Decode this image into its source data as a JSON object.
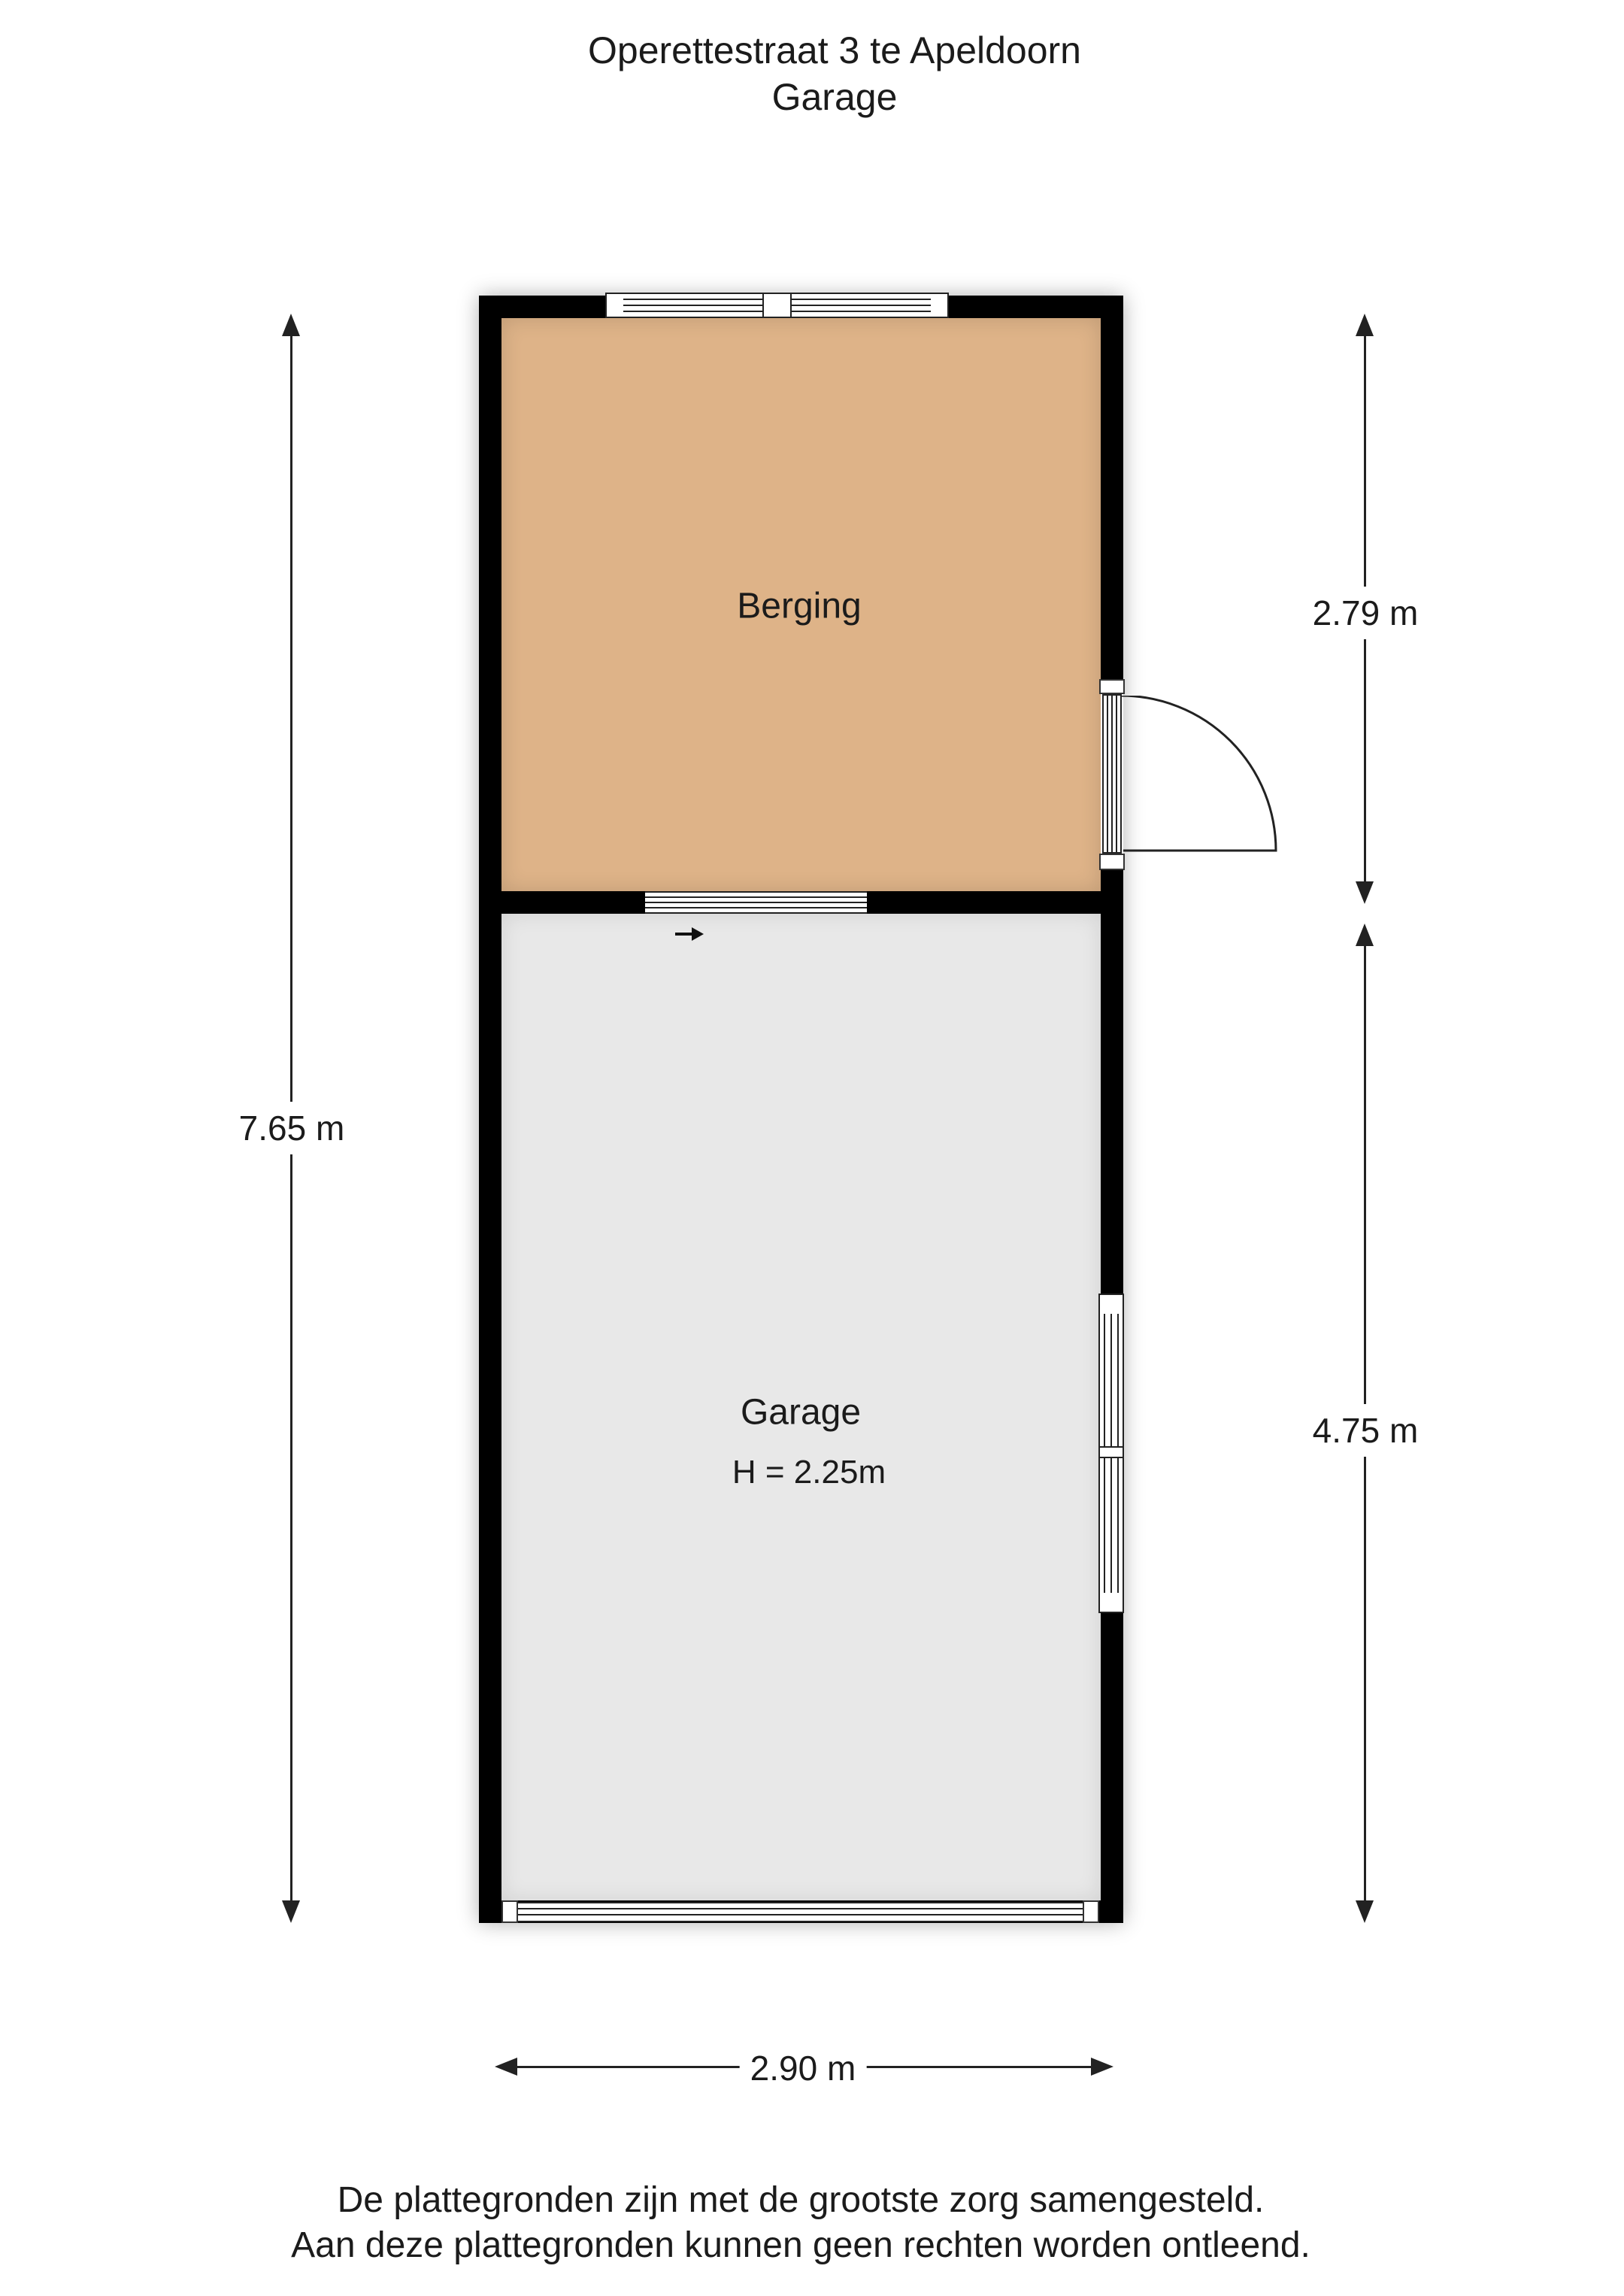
{
  "title": {
    "line1": "Operettestraat 3 te Apeldoorn",
    "line2": "Garage"
  },
  "rooms": {
    "berging": {
      "label": "Berging"
    },
    "garage": {
      "label": "Garage",
      "height_note": "H = 2.25m"
    }
  },
  "dimensions": {
    "overall_height": "7.65 m",
    "berging_height": "2.79 m",
    "garage_height": "4.75 m",
    "overall_width": "2.90 m"
  },
  "footer": {
    "line1": "De plattegronden zijn met de grootste zorg samengesteld.",
    "line2": "Aan deze plattegronden kunnen geen rechten worden ontleend."
  },
  "colors": {
    "wall": "#000000",
    "berging_fill": "#DEB388",
    "garage_fill": "#E8E8E8",
    "line_color": "#222222"
  }
}
